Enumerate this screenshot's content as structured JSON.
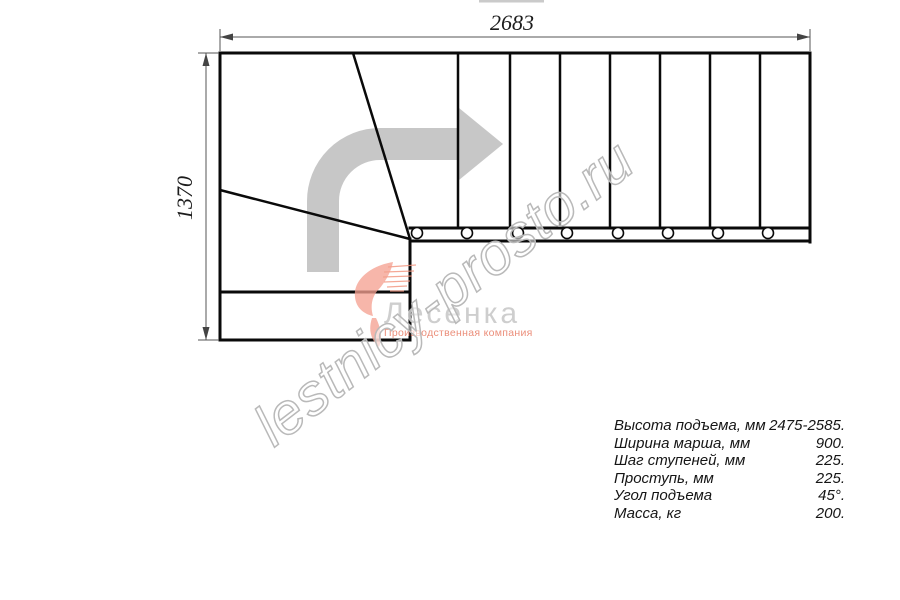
{
  "drawing": {
    "title_hint": "L-shaped staircase plan view",
    "top_dimension_label": "2683",
    "left_dimension_label": "1370",
    "tread_count_straight_run": 8,
    "baluster_count": 8,
    "winder_steps": 2
  },
  "watermark": {
    "text": "lestnicy-prosto.ru"
  },
  "logo": {
    "name": "Лесенка",
    "tagline": "Производственная компания"
  },
  "specs": {
    "rows": [
      {
        "label": "Высота подъема, мм",
        "value": "2475-2585."
      },
      {
        "label": "Ширина марша, мм",
        "value": "900."
      },
      {
        "label": "Шаг ступеней, мм",
        "value": "225."
      },
      {
        "label": "Проступь, мм",
        "value": "225."
      },
      {
        "label": "Угол подъема",
        "value": "45°."
      },
      {
        "label": "Масса, кг",
        "value": "200."
      }
    ]
  },
  "colors": {
    "line": "#0a0a0a",
    "dimension": "#555555",
    "direction_arrow": "#c7c7c7",
    "logo_gray": "#c9c9c9",
    "logo_salmon": "#f2957f",
    "watermark_outline": "#b9b9b9"
  }
}
